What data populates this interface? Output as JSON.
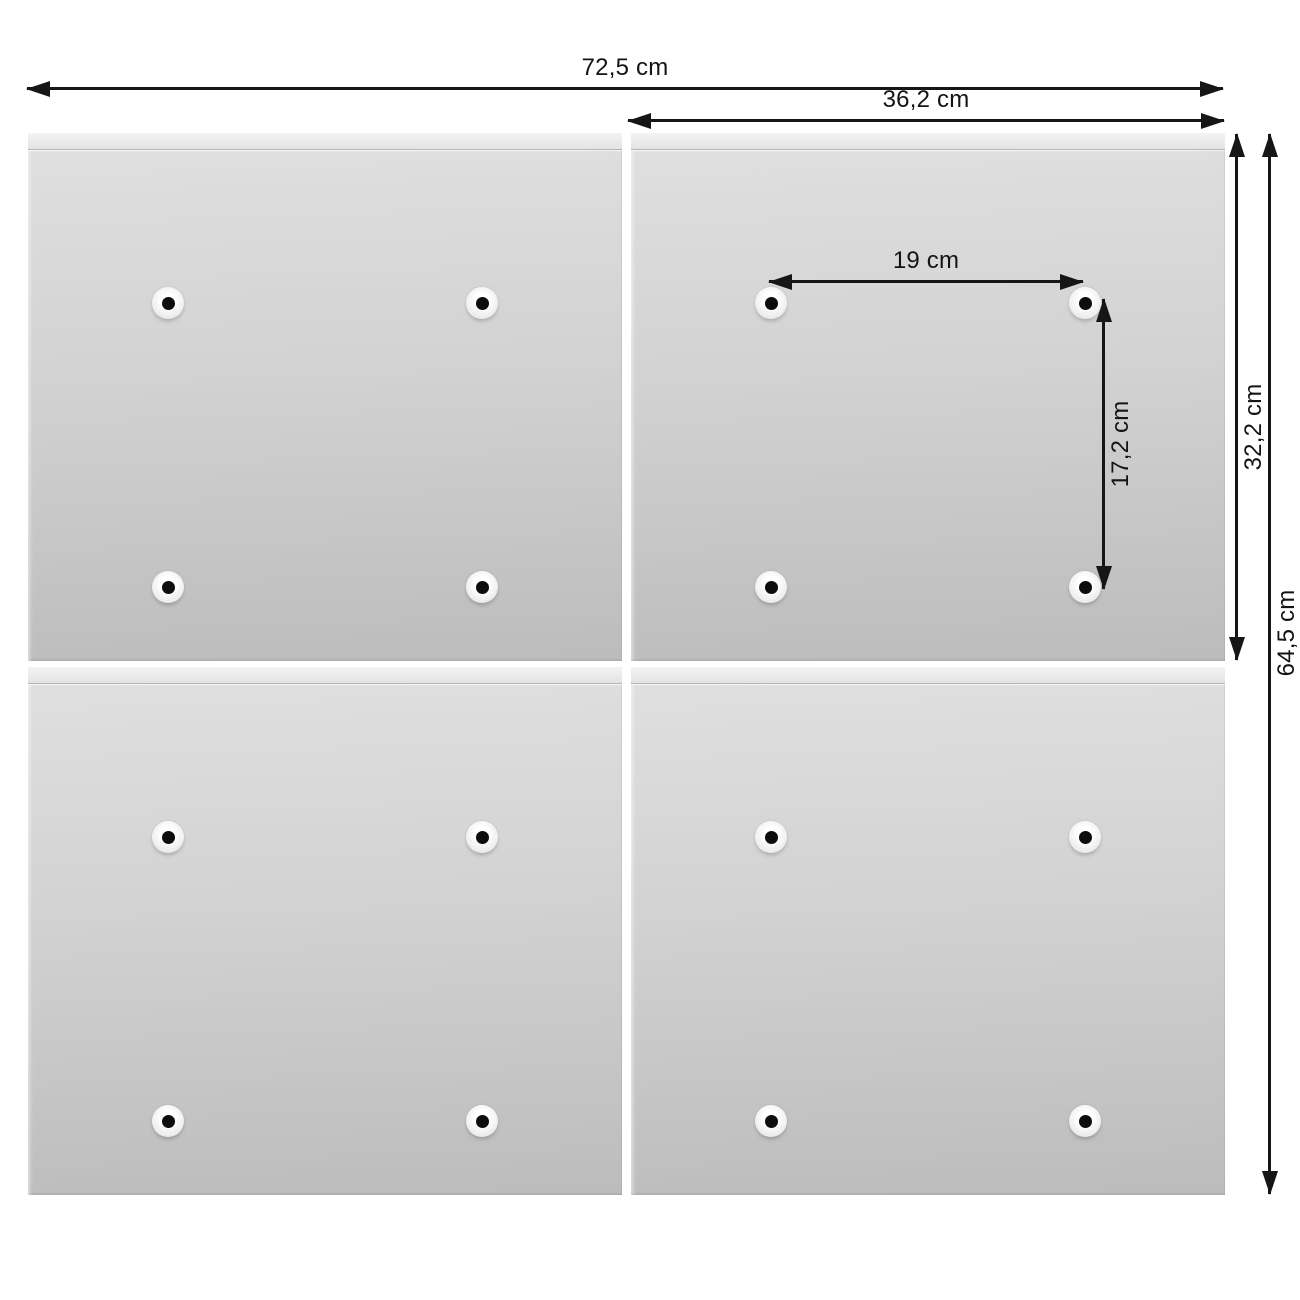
{
  "dimensions": {
    "total_width": "72,5 cm",
    "right_panel_width": "36,2 cm",
    "hole_spacing_horizontal": "19 cm",
    "hole_spacing_vertical": "17,2 cm",
    "panel_height": "32,2 cm",
    "total_height": "64,5 cm"
  },
  "colors": {
    "background": "#ffffff",
    "panel_light": "#e0e0e0",
    "panel_dark": "#bcbcbc",
    "annotation": "#161616"
  }
}
